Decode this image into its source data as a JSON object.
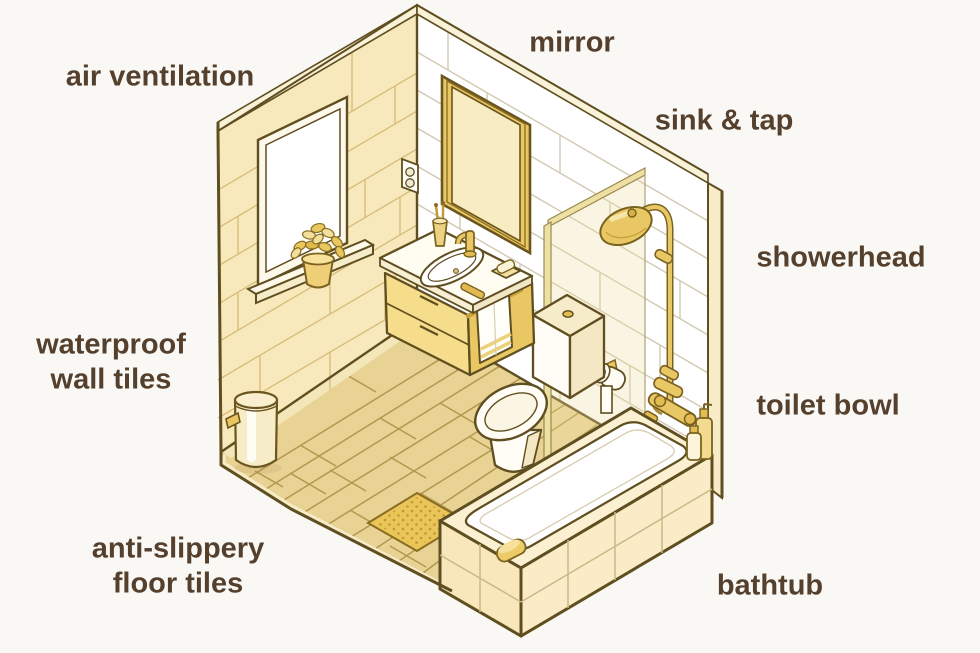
{
  "page": {
    "background": "#faf8f5"
  },
  "diagram": {
    "subject": "isometric bathroom features illustration",
    "labels": {
      "air_ventilation": "air ventilation",
      "mirror": "mirror",
      "sink_tap": "sink & tap",
      "showerhead": "showerhead",
      "waterproof_wall_tiles": "waterproof\nwall tiles",
      "toilet_bowl": "toilet bowl",
      "anti_slippery_floor_tiles": "anti-slippery\nfloor tiles",
      "bathtub": "bathtub"
    },
    "colors": {
      "label_text": "#54402c",
      "outline": "#5f4e20",
      "wall_left_yellow": "#f8e9bc",
      "wall_right_white": "#ffffff",
      "floor_tan": "#e8d395",
      "gold_accent": "#e9c765",
      "cream_fixture": "#fcf3d9",
      "anti_slip_mat": "#eac558",
      "background": "#faf8f5"
    }
  }
}
